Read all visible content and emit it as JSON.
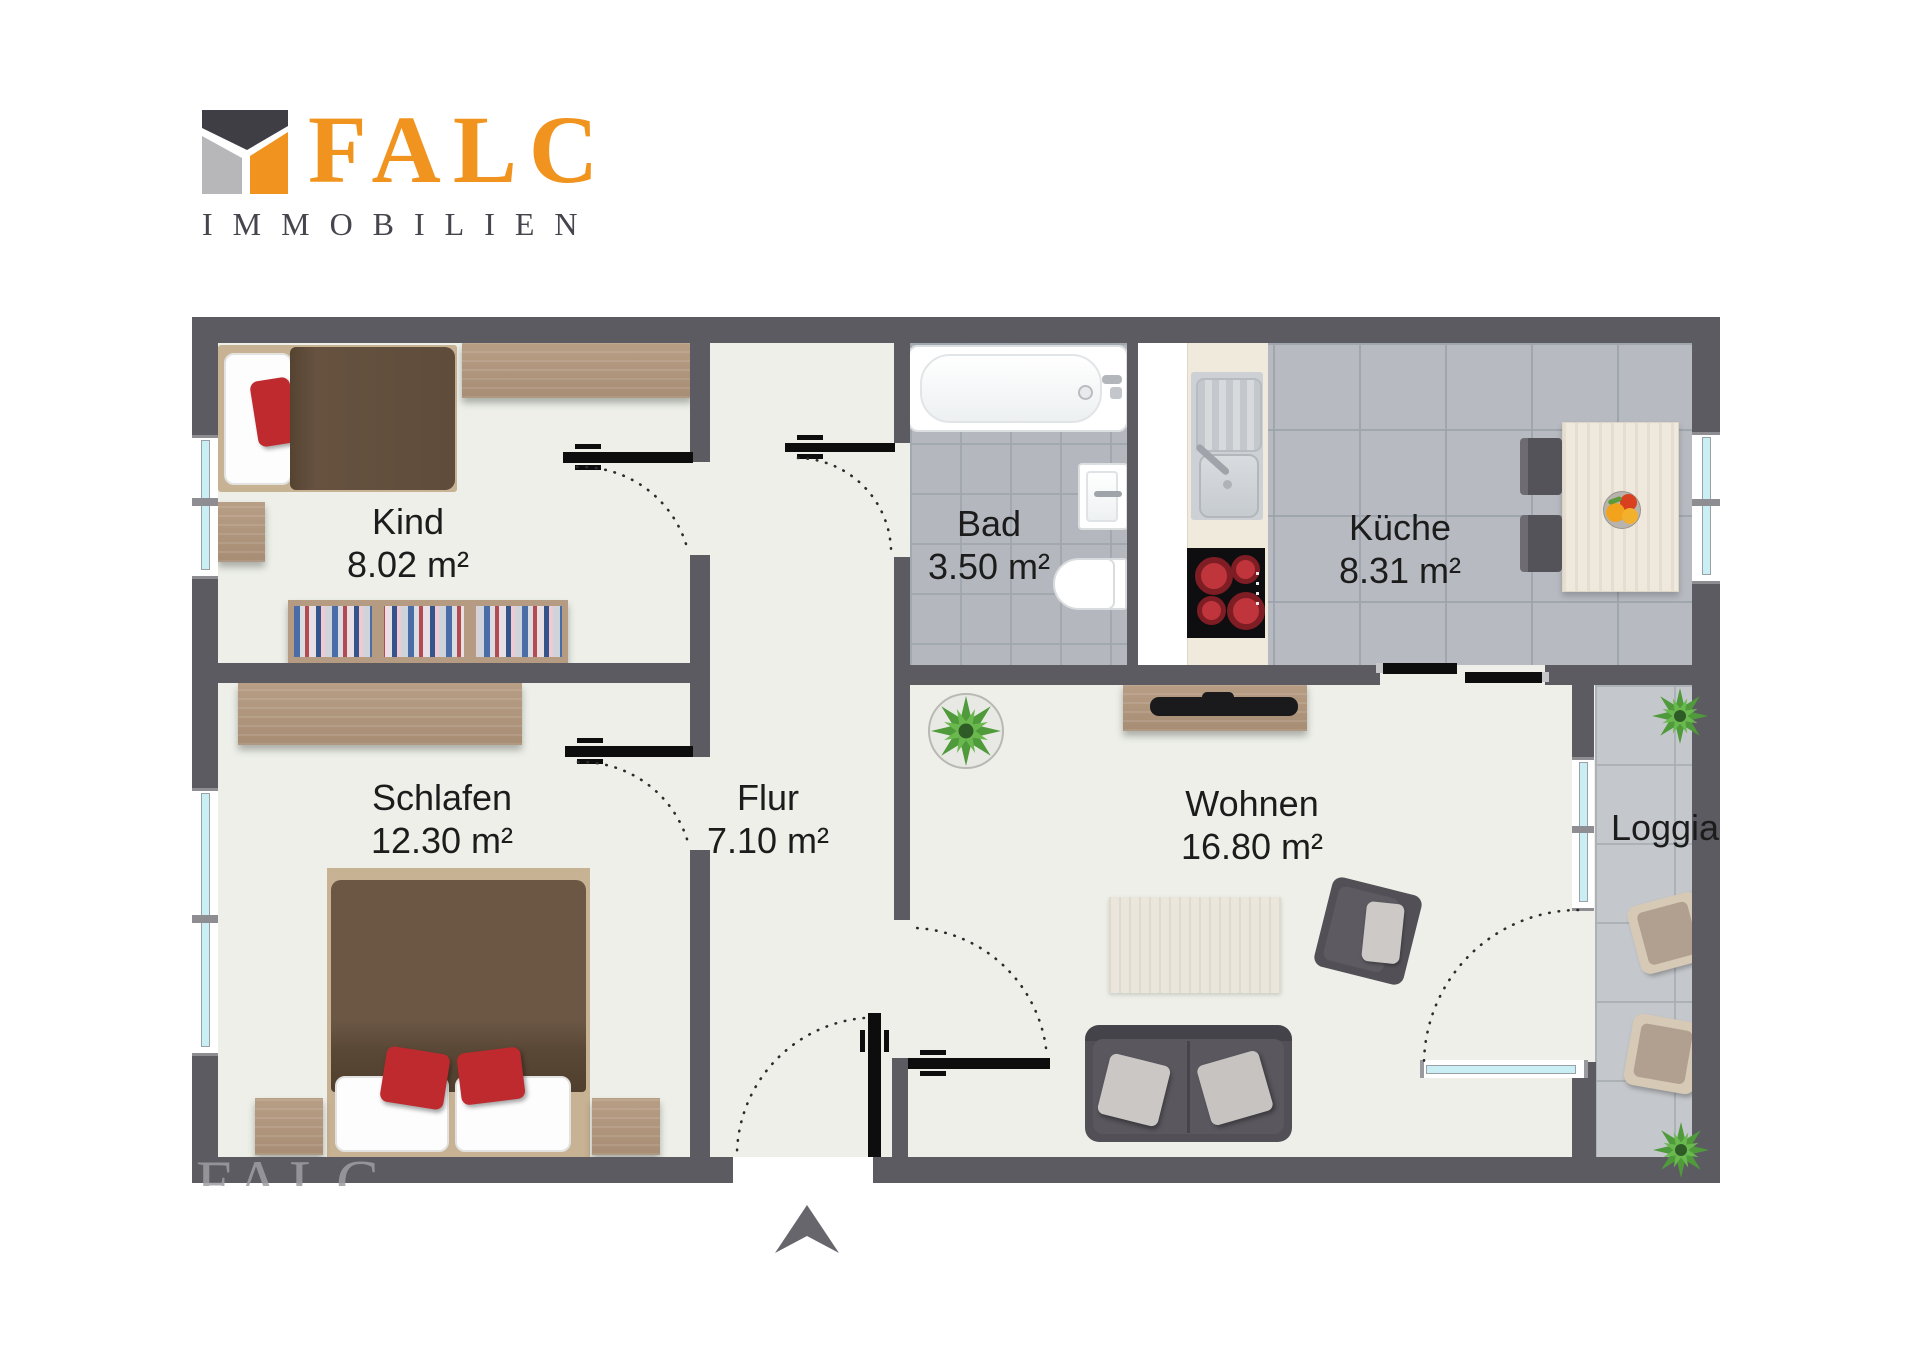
{
  "brand": {
    "logo_text": "FALC",
    "logo_subtitle": "IMMOBILIEN",
    "logo_color": "#f0941f",
    "subtitle_color": "#46454d"
  },
  "floorplan": {
    "watermark_text": "FALC",
    "north_arrow": "north-arrow",
    "rooms": [
      {
        "name": "Kind",
        "area": "8.02 m²"
      },
      {
        "name": "Bad",
        "area": "3.50 m²"
      },
      {
        "name": "Küche",
        "area": "8.31 m²"
      },
      {
        "name": "Schlafen",
        "area": "12.30 m²"
      },
      {
        "name": "Flur",
        "area": "7.10 m²"
      },
      {
        "name": "Wohnen",
        "area": "16.80 m²"
      },
      {
        "name": "Loggia",
        "area": ""
      }
    ],
    "colors": {
      "wall": "#5c5b61",
      "floor": "#edefe8",
      "bath_tile": "#b4b8be",
      "kitchen_tile": "#b7bbc1",
      "loggia_tile": "#c4c7cb",
      "window_glass": "#c9eef3",
      "accent_red": "#bf2a2e",
      "wood": "#b29879",
      "label_text": "#1c1c1c"
    }
  }
}
